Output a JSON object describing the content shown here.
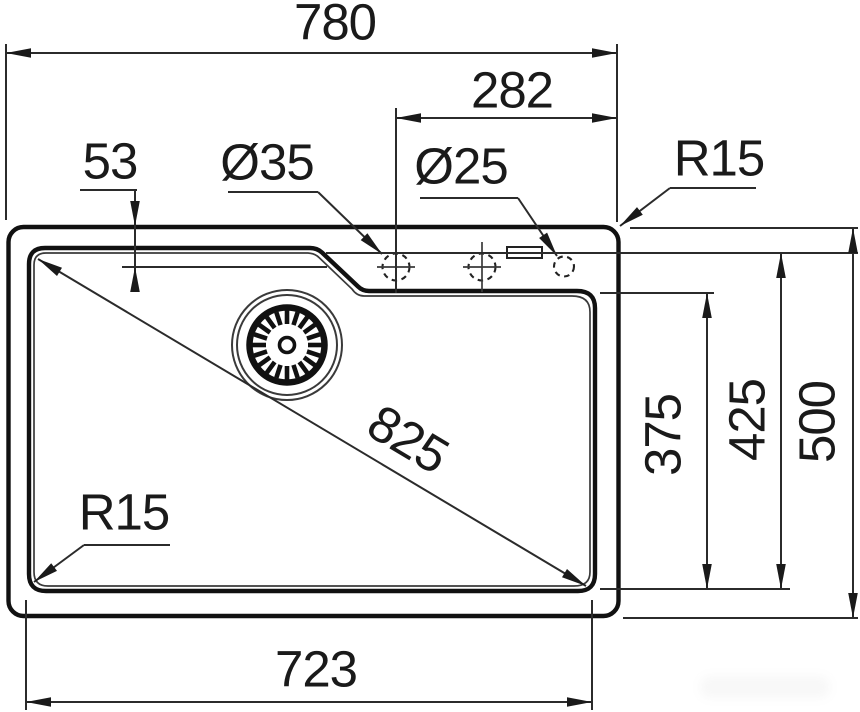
{
  "drawing": {
    "type": "sink-installation-dimension-drawing",
    "units_note": "",
    "dimensions": {
      "overall_width": "780",
      "tap_hole_offset_x": "282",
      "tap_hole_setback": "53",
      "tap_hole_diameter": "Ø35",
      "accessory_hole_diameter": "Ø25",
      "corner_radius_top": "R15",
      "diagonal": "825",
      "corner_radius_bowl": "R15",
      "bowl_width": "723",
      "bowl_inner_depth": "375",
      "bowl_depth": "425",
      "overall_depth": "500"
    }
  }
}
